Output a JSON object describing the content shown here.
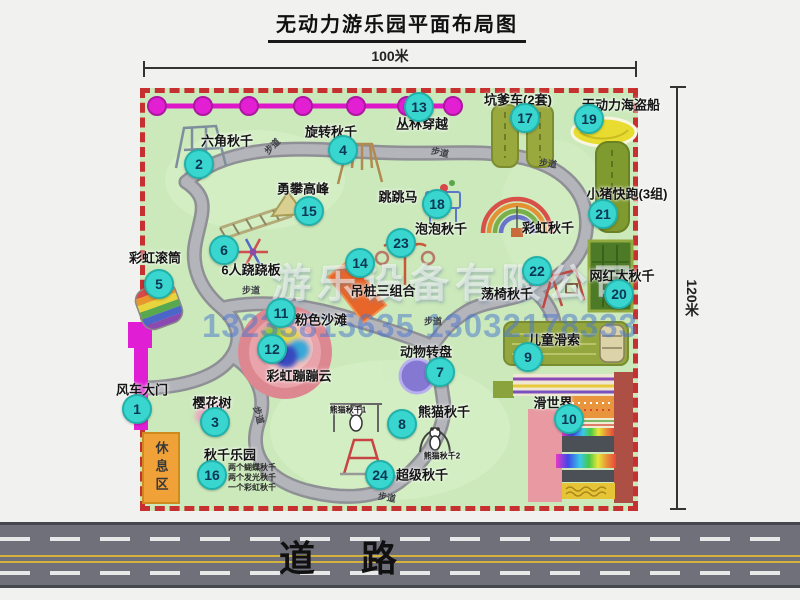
{
  "title": "无动力游乐园平面布局图",
  "dimensions": {
    "top": "100米",
    "right": "120米"
  },
  "road": {
    "label": "道 路"
  },
  "watermark": {
    "company": "游乐设备有限公司",
    "phones": "13233815635 13032178333"
  },
  "rest_area_label": "休息区",
  "walkway_text": "步道",
  "walkway_labels": [
    {
      "x": 272,
      "y": 146,
      "r": -45
    },
    {
      "x": 440,
      "y": 152,
      "r": 12
    },
    {
      "x": 548,
      "y": 163,
      "r": 8
    },
    {
      "x": 251,
      "y": 290,
      "r": 0
    },
    {
      "x": 433,
      "y": 321,
      "r": 0
    },
    {
      "x": 259,
      "y": 415,
      "r": 75
    },
    {
      "x": 387,
      "y": 497,
      "r": 10
    }
  ],
  "zipline": {
    "y": 106,
    "circle_xs": [
      157,
      203,
      249,
      303,
      356,
      407,
      453
    ]
  },
  "attractions": [
    {
      "num": "1",
      "label": "风车大门",
      "lx": 142,
      "ly": 389,
      "bx": 137,
      "by": 409
    },
    {
      "num": "2",
      "label": "六角秋千",
      "lx": 227,
      "ly": 140,
      "bx": 199,
      "by": 164
    },
    {
      "num": "3",
      "label": "樱花树",
      "lx": 212,
      "ly": 402,
      "bx": 215,
      "by": 422
    },
    {
      "num": "4",
      "label": "旋转秋千",
      "lx": 331,
      "ly": 131,
      "bx": 343,
      "by": 150
    },
    {
      "num": "5",
      "label": "彩虹滚筒",
      "lx": 155,
      "ly": 257,
      "bx": 159,
      "by": 284
    },
    {
      "num": "6",
      "label": "6人跷跷板",
      "lx": 251,
      "ly": 269,
      "bx": 224,
      "by": 250
    },
    {
      "num": "7",
      "label": "动物转盘",
      "lx": 426,
      "ly": 351,
      "bx": 440,
      "by": 372
    },
    {
      "num": "8",
      "label": "熊猫秋千",
      "lx": 444,
      "ly": 411,
      "bx": 402,
      "by": 424
    },
    {
      "num": "9",
      "label": "儿童滑索",
      "lx": 554,
      "ly": 339,
      "bx": 528,
      "by": 357
    },
    {
      "num": "10",
      "label": "滑世界",
      "lx": 553,
      "ly": 402,
      "bx": 569,
      "by": 419
    },
    {
      "num": "11",
      "label": "粉色沙滩",
      "lx": 321,
      "ly": 319,
      "bx": 281,
      "by": 313
    },
    {
      "num": "12",
      "label": "彩虹蹦蹦云",
      "lx": 299,
      "ly": 375,
      "bx": 272,
      "by": 349
    },
    {
      "num": "13",
      "label": "丛林穿越",
      "lx": 422,
      "ly": 123,
      "bx": 419,
      "by": 107
    },
    {
      "num": "14",
      "label": "吊桩三组合",
      "lx": 383,
      "ly": 290,
      "bx": 360,
      "by": 263
    },
    {
      "num": "15",
      "label": "勇攀高峰",
      "lx": 303,
      "ly": 188,
      "bx": 309,
      "by": 211
    },
    {
      "num": "16",
      "label": "秋千乐园",
      "lx": 230,
      "ly": 454,
      "bx": 212,
      "by": 475,
      "nx": 228,
      "ny": 463,
      "notes": [
        "两个蝴蝶秋千",
        "两个发光秋千",
        "一个彩虹秋千"
      ]
    },
    {
      "num": "17",
      "label": "坑爹车(2套)",
      "lx": 518,
      "ly": 99,
      "bx": 525,
      "by": 118
    },
    {
      "num": "18",
      "label": "跳跳马",
      "lx": 398,
      "ly": 196,
      "bx": 437,
      "by": 204
    },
    {
      "num": "19",
      "label": "无动力海盗船",
      "lx": 621,
      "ly": 104,
      "bx": 589,
      "by": 119
    },
    {
      "num": "20",
      "label": "网红大秋千",
      "lx": 622,
      "ly": 275,
      "bx": 619,
      "by": 294
    },
    {
      "num": "21",
      "label": "小猪快跑(3组)",
      "lx": 627,
      "ly": 193,
      "bx": 603,
      "by": 214
    },
    {
      "num": "22",
      "label": "荡椅秋千",
      "lx": 507,
      "ly": 293,
      "bx": 537,
      "by": 271
    },
    {
      "num": "23",
      "label": "泡泡秋千",
      "lx": 441,
      "ly": 228,
      "bx": 401,
      "by": 243
    },
    {
      "num": "24",
      "label": "超级秋千",
      "lx": 422,
      "ly": 474,
      "bx": 380,
      "by": 475
    }
  ],
  "extra_labels": [
    {
      "text": "彩虹秋千",
      "x": 548,
      "y": 227,
      "fs": 13
    },
    {
      "text": "熊猫秋千1",
      "x": 348,
      "y": 410,
      "fs": 8
    },
    {
      "text": "熊猫秋千2",
      "x": 442,
      "y": 456,
      "fs": 8
    }
  ]
}
